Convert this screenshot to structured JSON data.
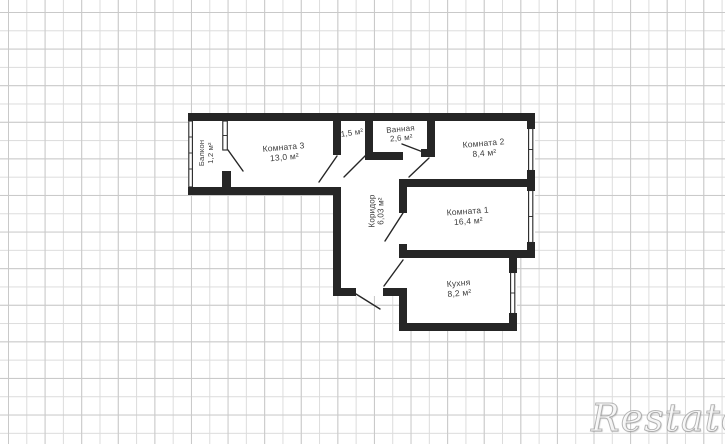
{
  "watermark": {
    "text": "Restate"
  },
  "rooms": {
    "balcony": {
      "name": "Балкон",
      "area": "1,2 м²"
    },
    "room3": {
      "name": "Комната 3",
      "area": "13,0 м²"
    },
    "storage": {
      "name": "",
      "area": "1,5 м²"
    },
    "bathroom": {
      "name": "Ванная",
      "area": "2,6 м²"
    },
    "room2": {
      "name": "Комната 2",
      "area": "8,4 м²"
    },
    "corridor": {
      "name": "Коридор",
      "area": "6,03 м²"
    },
    "room1": {
      "name": "Комната 1",
      "area": "16,4 м²"
    },
    "kitchen": {
      "name": "Кухня",
      "area": "8,2 м²"
    }
  },
  "colors": {
    "wall": "#262626",
    "grid_line": "#dcdcdc",
    "grid_major": "#c9c9c9",
    "background": "#ffffff",
    "label_text": "#3d3d3d"
  }
}
